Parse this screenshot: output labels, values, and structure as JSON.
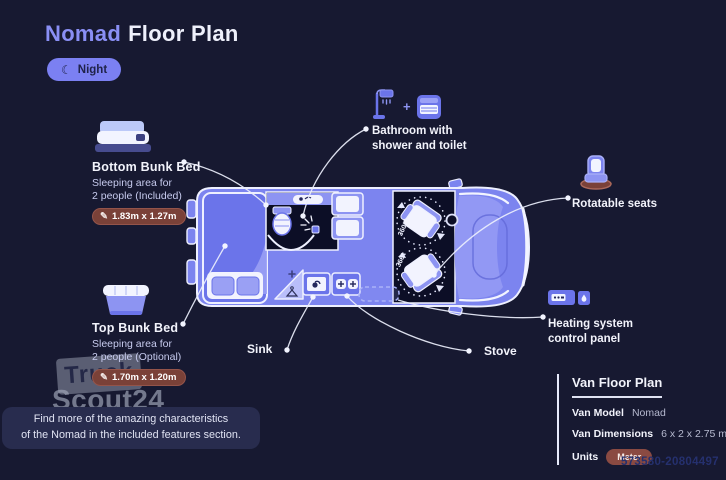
{
  "title": {
    "brand": "Nomad",
    "rest": "Floor Plan"
  },
  "mode": {
    "label": "Night"
  },
  "icons": {
    "pencil": "✎",
    "moon": "☾"
  },
  "annotations": {
    "bottom_bunk": {
      "title": "Bottom Bunk Bed",
      "line1": "Sleeping area for",
      "line2": "2 people (Included)",
      "dimensions": "1.83m x 1.27m"
    },
    "top_bunk": {
      "title": "Top Bunk Bed",
      "line1": "Sleeping area for",
      "line2": "2 people (Optional)",
      "dimensions": "1.70m x 1.20m"
    },
    "bathroom": {
      "plus": "+",
      "line1": "Bathroom with",
      "line2": "shower and toilet"
    },
    "rotatable_seats": {
      "title": "Rotatable seats"
    },
    "heating": {
      "line1": "Heating system",
      "line2": "control panel"
    },
    "sink": {
      "title": "Sink"
    },
    "stove": {
      "title": "Stove"
    }
  },
  "floorplan": {
    "seat_rotation": "360°"
  },
  "info_panel": {
    "title": "Van Floor Plan",
    "rows": [
      {
        "label": "Van Model",
        "value": "Nomad"
      },
      {
        "label": "Van Dimensions",
        "value": "6 x 2 x 2.75 m"
      },
      {
        "label": "Units",
        "value": "Meter"
      }
    ]
  },
  "note": {
    "line1": "Find more of the amazing characteristics",
    "line2": "of the Nomad in the included features section."
  },
  "watermark": {
    "brand_top": "Truck",
    "brand_bottom": "Scout24",
    "ref_number": "573580-20804497"
  },
  "colors": {
    "background": "#171931",
    "accent": "#8a8ff5",
    "van_blue": "#7c84ef",
    "badge_brown": "#7a4138",
    "night_pill": "#7b80f2"
  }
}
